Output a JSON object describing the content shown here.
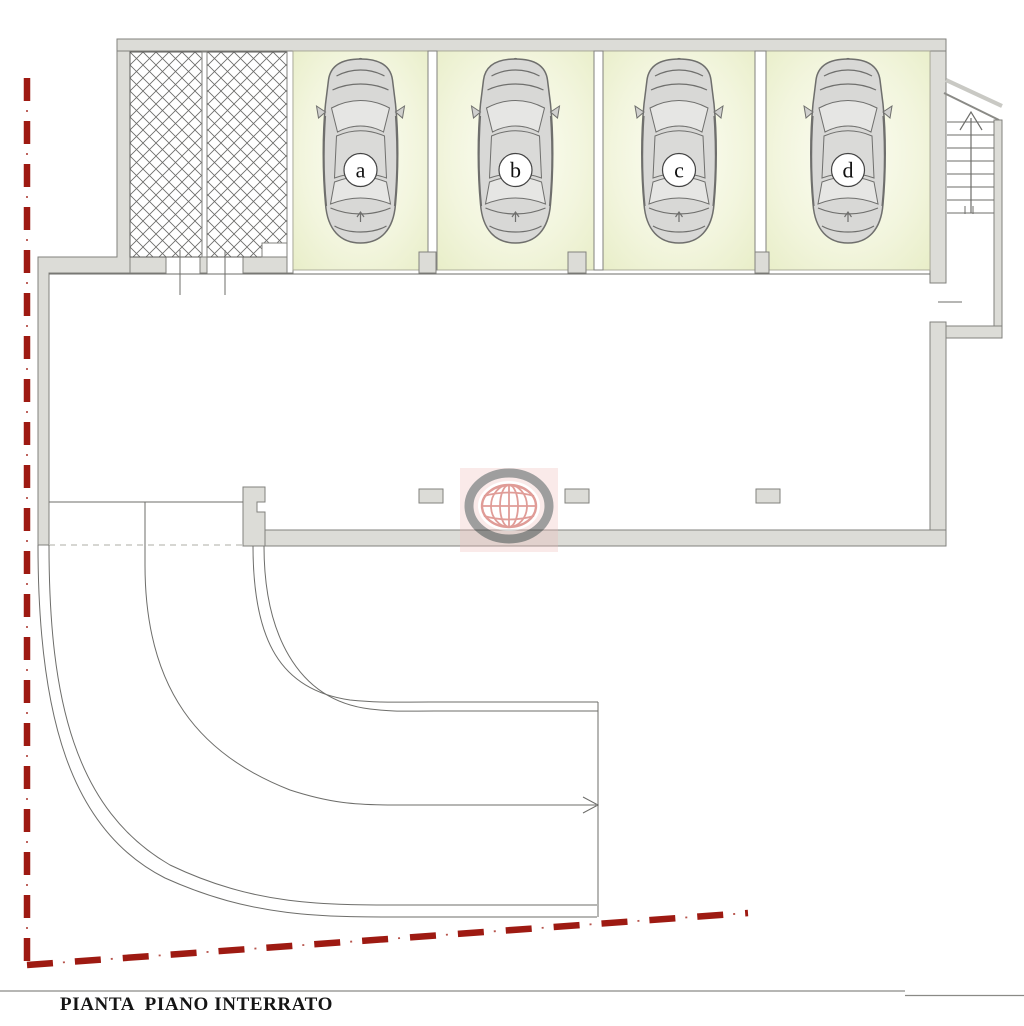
{
  "document": {
    "caption": "PIANTA  PIANO INTERRATO"
  },
  "plan": {
    "garage_stalls": [
      {
        "label": "a"
      },
      {
        "label": "b"
      },
      {
        "label": "c"
      },
      {
        "label": "d"
      }
    ]
  },
  "icons": {
    "car": "car-top-view-icon",
    "watermark": "globe-logo",
    "stair_arrow": "up-arrow-icon",
    "ramp_arrow": "right-arrow-icon"
  },
  "colors": {
    "boundary_red": "#9e1a12",
    "boundary_red_light": "#b7544c",
    "wall_fill": "#dcdcd7",
    "wall_edge": "#82827e",
    "line_gray": "#6d6d6a",
    "light_line": "#c9c9c4",
    "hatch_line": "#6a6a68",
    "stall_green_edge": "#e6ecc3",
    "stall_green_mid": "#f2f5dd",
    "stall_green_center": "#fcfdf3",
    "car_gray": "#d8d8d6",
    "car_window": "#e6e6e4",
    "watermark_pink": "#eeb9b6",
    "watermark_ring": "#3f3f3f",
    "watermark_red": "#c23b32",
    "caption_ink": "#151515"
  }
}
